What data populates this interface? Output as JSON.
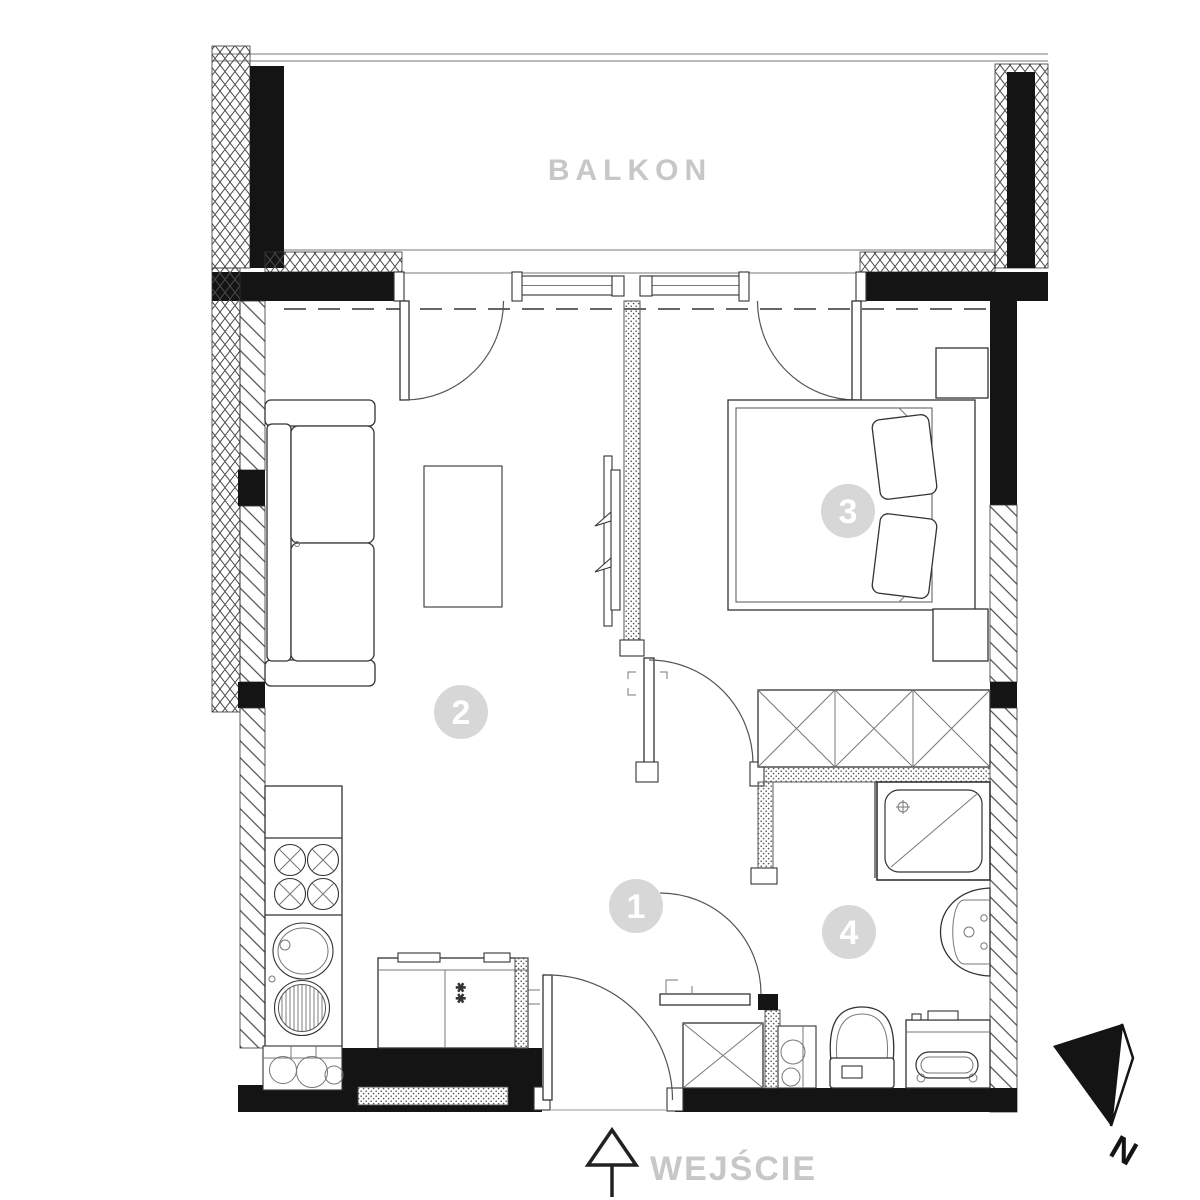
{
  "labels": {
    "balcony": "BALKON",
    "entrance": "WEJŚCIE",
    "north": "N"
  },
  "room_numbers": [
    "1",
    "2",
    "3",
    "4"
  ],
  "marks": {
    "appliance": "✱✱"
  },
  "colors": {
    "label_gray": "#c7c7c7",
    "badge_fill": "#d7d7d7",
    "badge_text": "#ffffff",
    "ink": "#141414"
  }
}
